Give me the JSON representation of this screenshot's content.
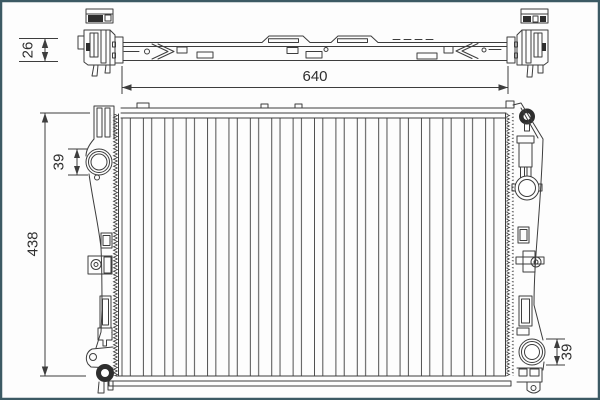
{
  "frame": {
    "border_color": "#3c5a64",
    "background_color": "#fdfdfd"
  },
  "drawing": {
    "line_color": "#3d3d3d",
    "dimensions": {
      "top_view_depth": "26",
      "core_width": "640",
      "overall_height": "438",
      "inlet_port_diameter": "39",
      "outlet_port_diameter": "39"
    }
  }
}
